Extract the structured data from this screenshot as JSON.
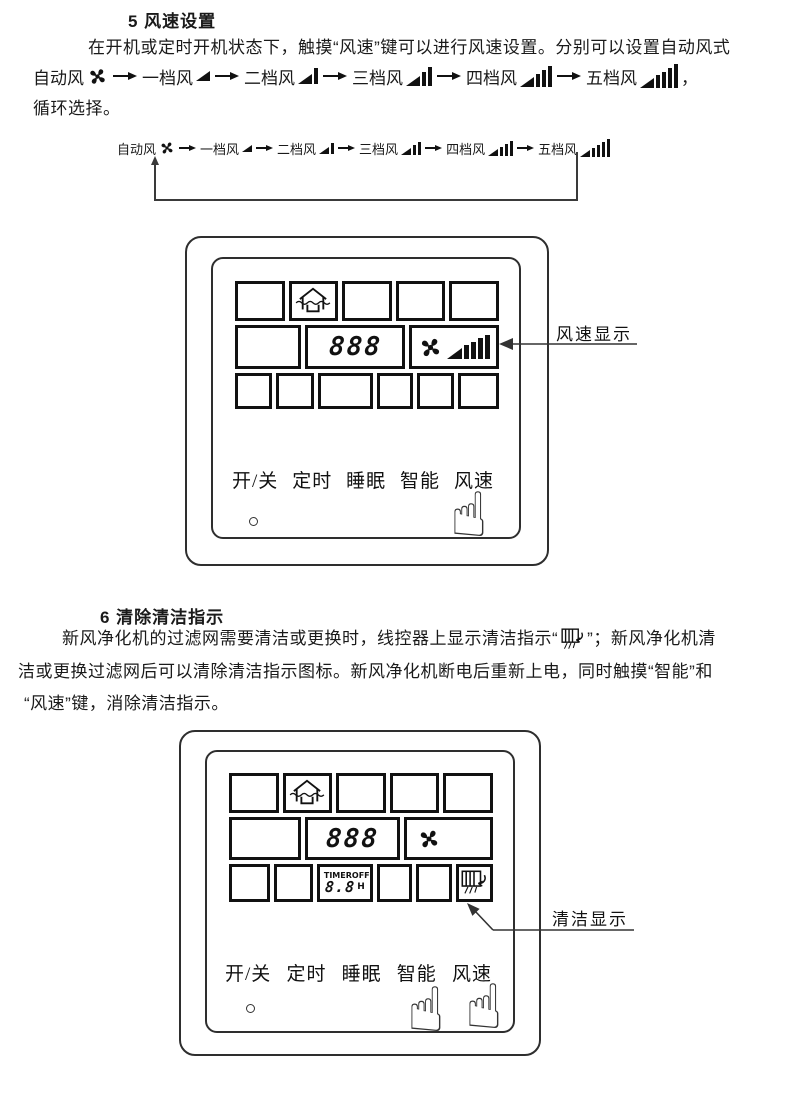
{
  "section5": {
    "heading": "5 风速设置",
    "intro": "在开机或定时开机状态下，触摸“风速”键可以进行风速设置。分别可以设置自动风式",
    "trailing_comma": "，",
    "outro": "循环选择。"
  },
  "fan_speeds": [
    {
      "label": "自动风"
    },
    {
      "label": "一档风"
    },
    {
      "label": "二档风"
    },
    {
      "label": "三档风"
    },
    {
      "label": "四档风"
    },
    {
      "label": "五档风"
    }
  ],
  "panel1": {
    "lcd_number": "888",
    "buttons": [
      "开/关",
      "定时",
      "睡眠",
      "智能",
      "风速"
    ],
    "annotation": "风速显示"
  },
  "panel2": {
    "lcd_number": "888",
    "timer_label": "TIMER",
    "timer_state": "OFF",
    "timer_value": "8.8",
    "timer_unit": "H",
    "buttons": [
      "开/关",
      "定时",
      "睡眠",
      "智能",
      "风速"
    ],
    "annotation": "清洁显示"
  },
  "section6": {
    "heading": "6 清除清洁指示",
    "line1_before_icon": "新风净化机的过滤网需要清洁或更换时，线控器上显示清洁指示“",
    "line1_after_icon": "”；新风净化机清",
    "line2": "洁或更换过滤网后可以清除清洁指示图标。新风净化机断电后重新上电，同时触摸“智能”和",
    "line3": "“风速”键，消除清洁指示。"
  },
  "colors": {
    "ink": "#111111",
    "line": "#3a3a3a"
  }
}
